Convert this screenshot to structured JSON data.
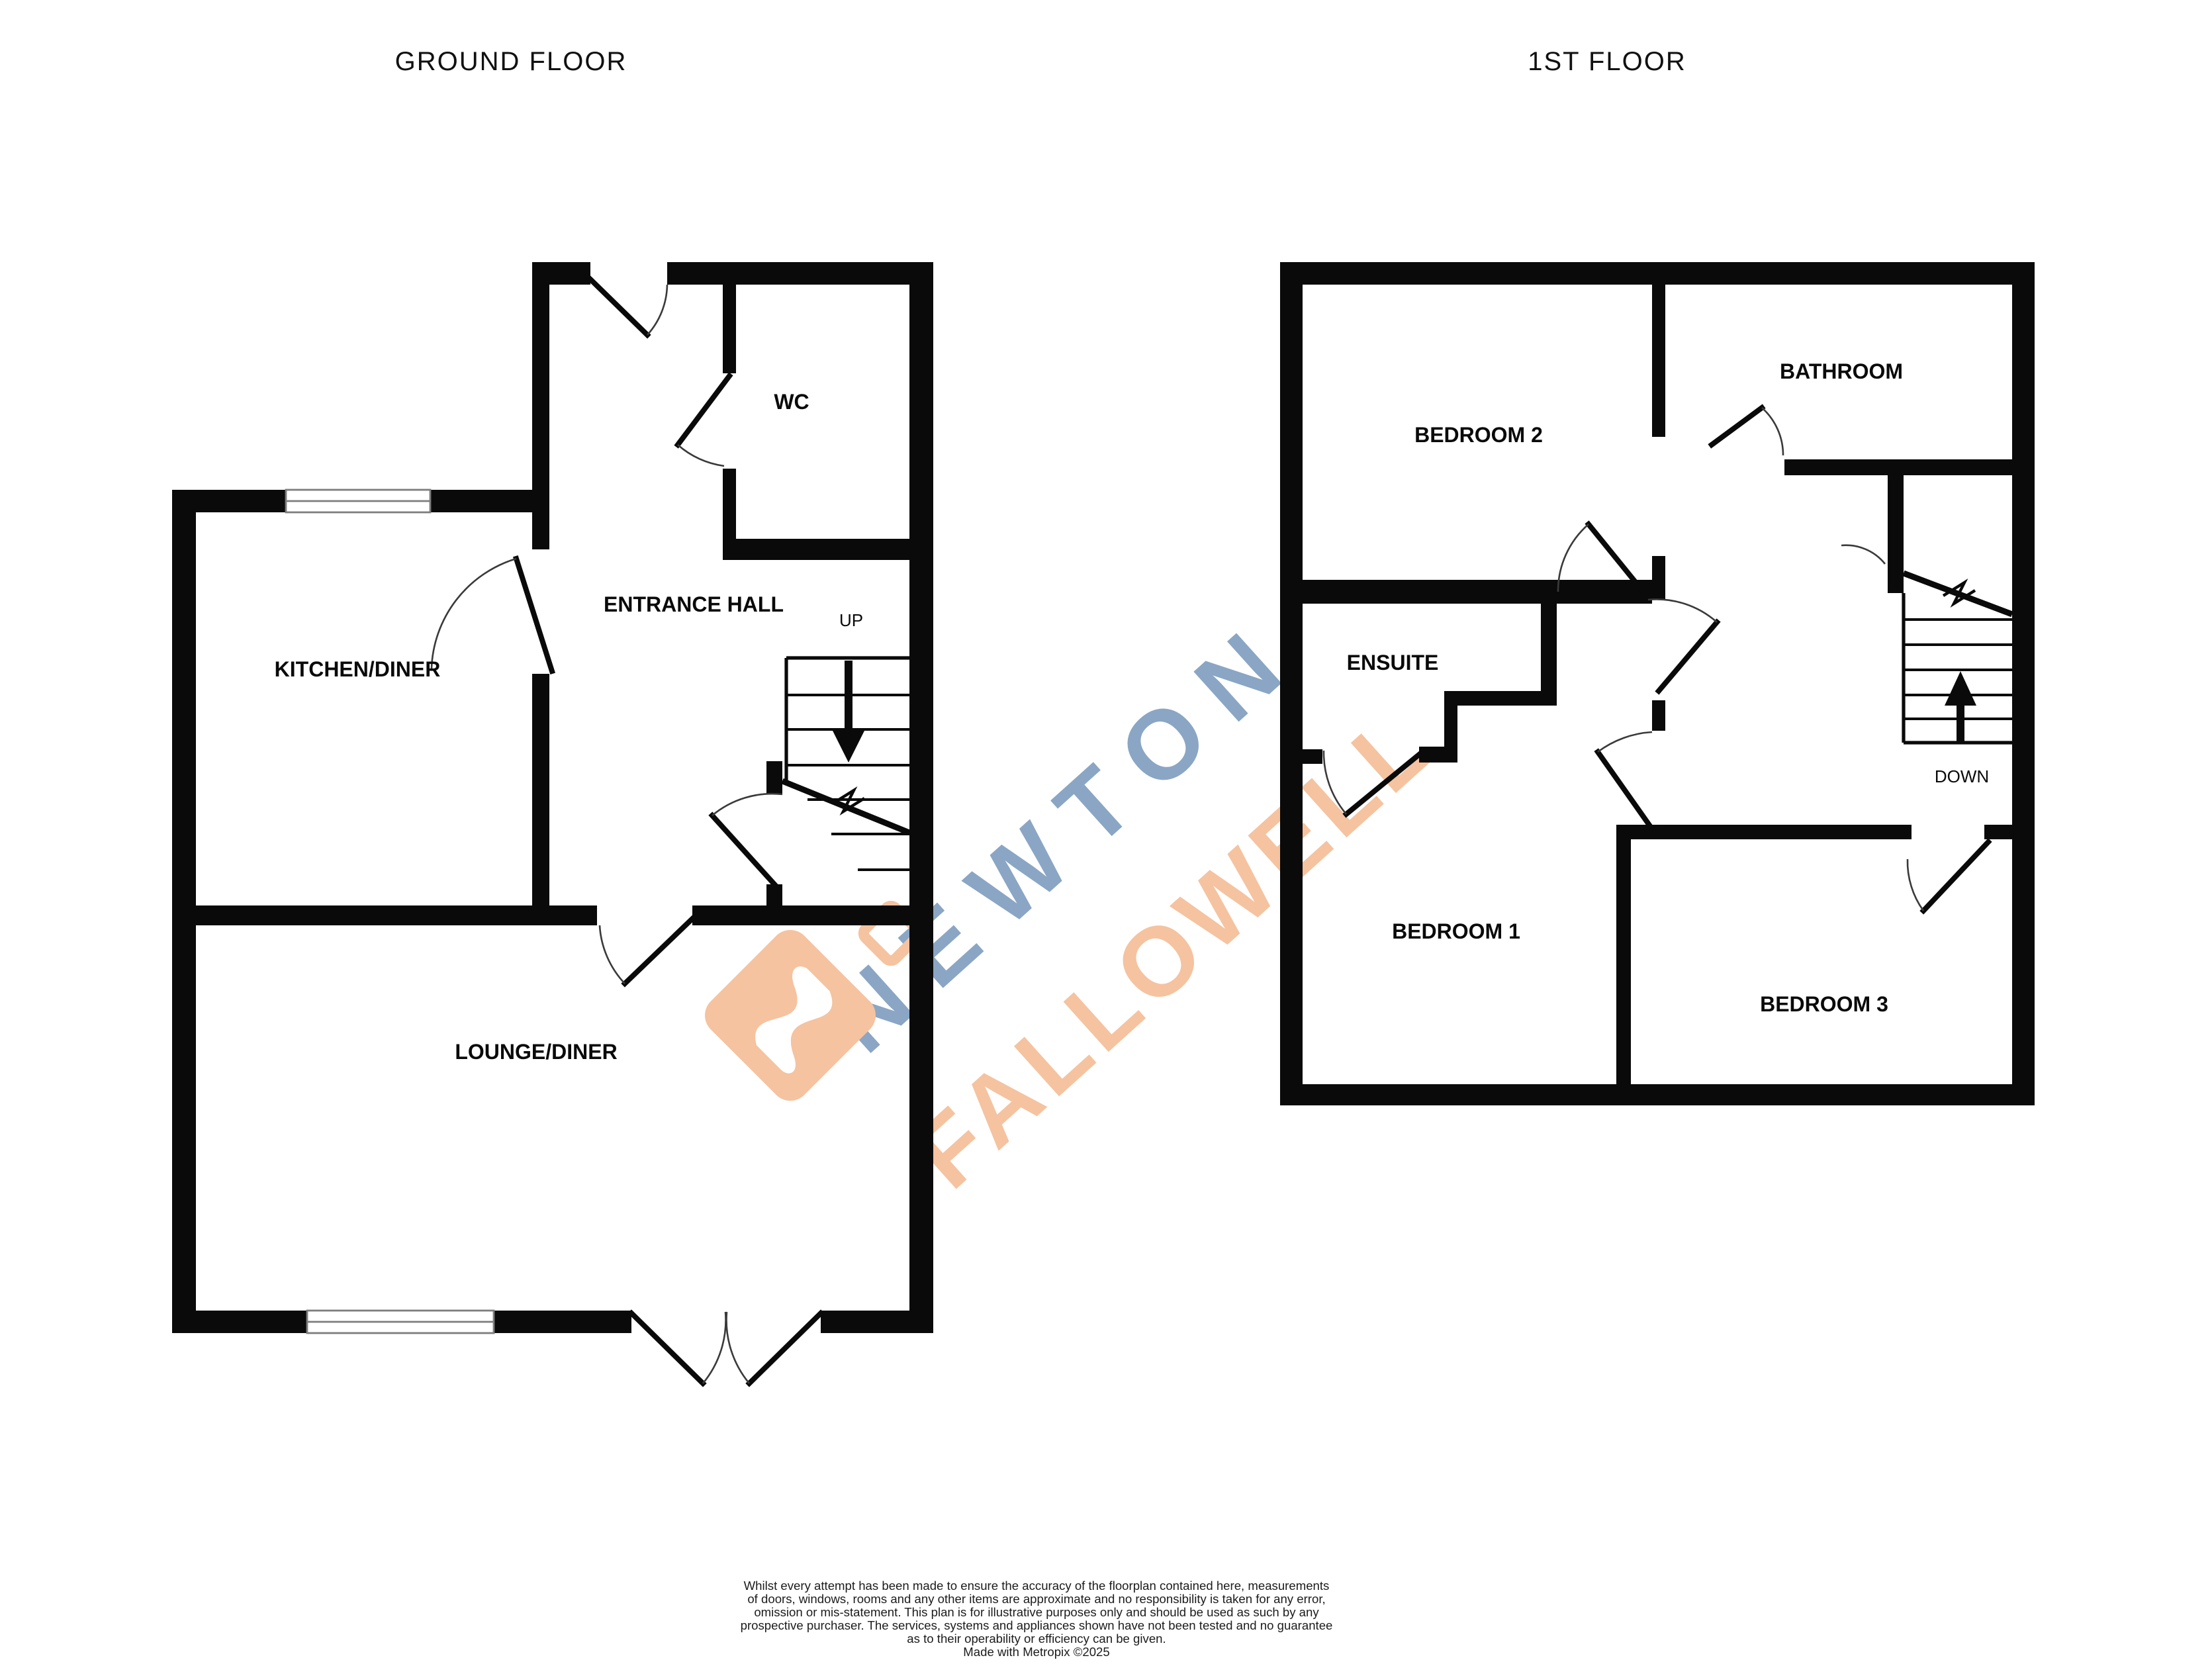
{
  "ground_floor": {
    "title": "GROUND FLOOR",
    "labels": {
      "kitchen_diner": "KITCHEN/DINER",
      "entrance_hall": "ENTRANCE HALL",
      "wc": "WC",
      "up": "UP",
      "lounge_diner": "LOUNGE/DINER"
    }
  },
  "first_floor": {
    "title": "1ST FLOOR",
    "labels": {
      "bedroom2": "BEDROOM 2",
      "bathroom": "BATHROOM",
      "ensuite": "ENSUITE",
      "bedroom1": "BEDROOM 1",
      "bedroom3": "BEDROOM 3",
      "down": "DOWN"
    }
  },
  "watermark": {
    "word1": "NEWTON",
    "word2": "FALLOWELL",
    "color_blue": "#8aa6c4",
    "color_orange": "#f5c3a0"
  },
  "disclaimer": {
    "lines": [
      "Whilst every attempt has been made to ensure the accuracy of the floorplan contained here, measurements",
      "of doors, windows, rooms and any other items are approximate and no responsibility is taken for any error,",
      "omission or mis-statement. This plan is for illustrative purposes only and should be used as such by any",
      "prospective purchaser. The services, systems and appliances shown have not been tested and no guarantee",
      "as to their operability or efficiency can be given.",
      "Made with Metropix ©2025"
    ]
  }
}
